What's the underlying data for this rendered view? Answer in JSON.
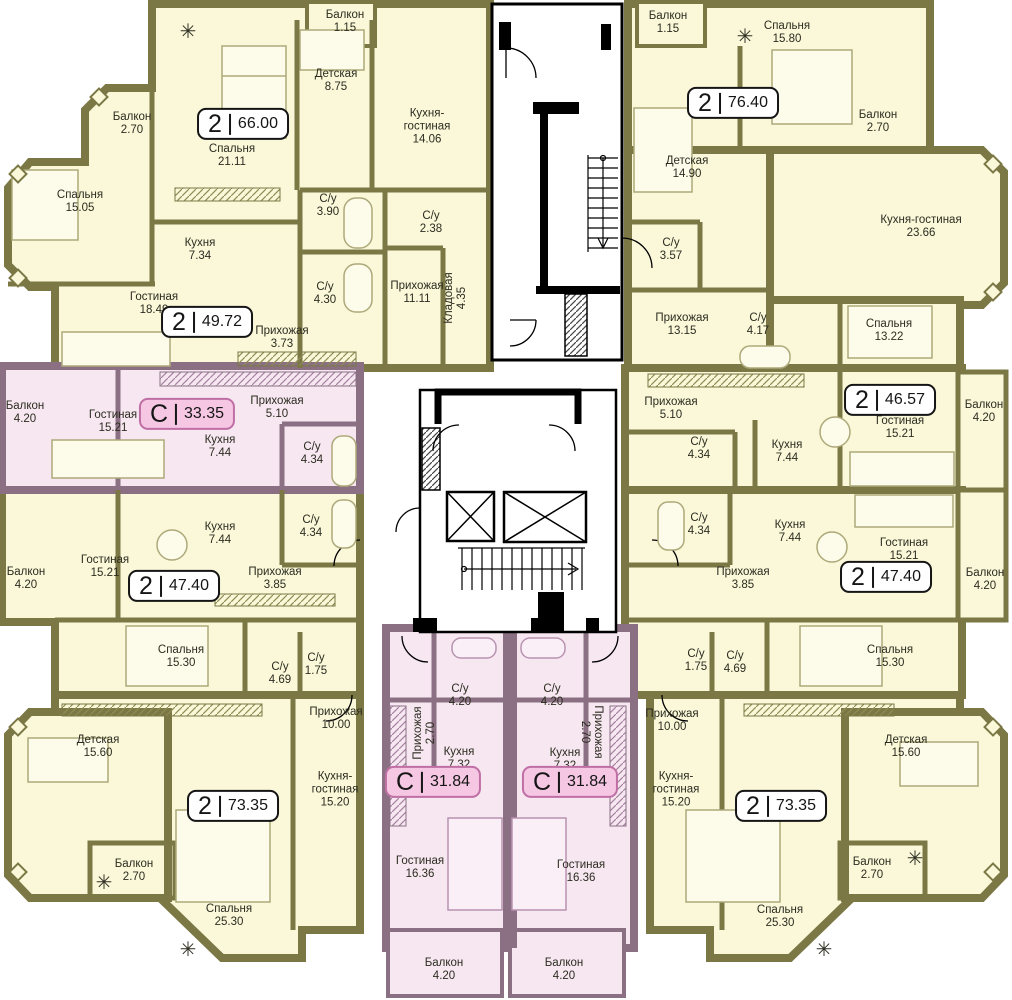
{
  "colors": {
    "apartment_fill": "#FAF8D9",
    "apartment_wall": "#7B7845",
    "studio_fill": "#F6E7F1",
    "studio_wall": "#8A7082",
    "core_wall": "#000000",
    "badge_two_fill": "#FFFFFF",
    "badge_studio_fill": "#F5C7E2",
    "badge_studio_border": "#C06FA5"
  },
  "apartments": [
    {
      "id": "apt-2-66",
      "type": "2",
      "area_total": "66.00",
      "rooms": [
        {
          "name": "Балкон",
          "area": "1.15"
        },
        {
          "name": "Детская",
          "area": "8.75"
        },
        {
          "name": "Кухня-гостиная",
          "area": "14.06"
        },
        {
          "name": "Спальня",
          "area": "21.11"
        },
        {
          "name": "С/у",
          "area": "3.90"
        },
        {
          "name": "С/у",
          "area": "2.38"
        },
        {
          "name": "Прихожая",
          "area": "11.11"
        },
        {
          "name": "Кладовая",
          "area": "4.35"
        }
      ]
    },
    {
      "id": "apt-2-49",
      "type": "2",
      "area_total": "49.72",
      "rooms": [
        {
          "name": "Балкон",
          "area": "2.70"
        },
        {
          "name": "Спальня",
          "area": "15.05"
        },
        {
          "name": "Кухня",
          "area": "7.34"
        },
        {
          "name": "Гостиная",
          "area": "18.49"
        },
        {
          "name": "С/у",
          "area": "4.30"
        },
        {
          "name": "Прихожая",
          "area": "3.73"
        }
      ]
    },
    {
      "id": "studio-33",
      "type": "C",
      "area_total": "33.35",
      "rooms": [
        {
          "name": "Балкон",
          "area": "4.20"
        },
        {
          "name": "Гостиная",
          "area": "15.21"
        },
        {
          "name": "Прихожая",
          "area": "5.10"
        },
        {
          "name": "Кухня",
          "area": "7.44"
        },
        {
          "name": "С/у",
          "area": "4.34"
        }
      ]
    },
    {
      "id": "apt-2-47-left",
      "type": "2",
      "area_total": "47.40",
      "rooms": [
        {
          "name": "Балкон",
          "area": "4.20"
        },
        {
          "name": "Гостиная",
          "area": "15.21"
        },
        {
          "name": "Кухня",
          "area": "7.44"
        },
        {
          "name": "С/у",
          "area": "4.34"
        },
        {
          "name": "Прихожая",
          "area": "3.85"
        },
        {
          "name": "Спальня",
          "area": "15.30"
        },
        {
          "name": "С/у",
          "area": "1.75"
        }
      ]
    },
    {
      "id": "apt-2-73-left",
      "type": "2",
      "area_total": "73.35",
      "rooms": [
        {
          "name": "С/у",
          "area": "4.69"
        },
        {
          "name": "Прихожая",
          "area": "10.00"
        },
        {
          "name": "Детская",
          "area": "15.60"
        },
        {
          "name": "Кухня-гостиная",
          "area": "15.20"
        },
        {
          "name": "Балкон",
          "area": "2.70"
        },
        {
          "name": "Спальня",
          "area": "25.30"
        }
      ]
    },
    {
      "id": "studio-31-left",
      "type": "C",
      "area_total": "31.84",
      "rooms": [
        {
          "name": "С/у",
          "area": "4.20"
        },
        {
          "name": "Прихожая",
          "area": "2.70"
        },
        {
          "name": "Кухня",
          "area": "7.32"
        },
        {
          "name": "Гостиная",
          "area": "16.36"
        },
        {
          "name": "Балкон",
          "area": "4.20"
        }
      ]
    },
    {
      "id": "studio-31-right",
      "type": "C",
      "area_total": "31.84",
      "rooms": [
        {
          "name": "С/у",
          "area": "4.20"
        },
        {
          "name": "Прихожая",
          "area": "2.70"
        },
        {
          "name": "Кухня",
          "area": "7.32"
        },
        {
          "name": "Гостиная",
          "area": "16.36"
        },
        {
          "name": "Балкон",
          "area": "4.20"
        }
      ]
    },
    {
      "id": "apt-2-76",
      "type": "2",
      "area_total": "76.40",
      "rooms": [
        {
          "name": "Балкон",
          "area": "1.15"
        },
        {
          "name": "Спальня",
          "area": "15.80"
        },
        {
          "name": "Балкон",
          "area": "2.70"
        },
        {
          "name": "Детская",
          "area": "14.90"
        },
        {
          "name": "С/у",
          "area": "3.57"
        },
        {
          "name": "Кухня-гостиная",
          "area": "23.66"
        },
        {
          "name": "Прихожая",
          "area": "13.15"
        },
        {
          "name": "С/у",
          "area": "4.17"
        }
      ]
    },
    {
      "id": "apt-2-46",
      "type": "2",
      "area_total": "46.57",
      "rooms": [
        {
          "name": "Спальня",
          "area": "13.22"
        },
        {
          "name": "Прихожая",
          "area": "5.10"
        },
        {
          "name": "С/у",
          "area": "4.34"
        },
        {
          "name": "Кухня",
          "area": "7.44"
        },
        {
          "name": "Гостиная",
          "area": "15.21"
        },
        {
          "name": "Балкон",
          "area": "4.20"
        }
      ]
    },
    {
      "id": "apt-2-47-right",
      "type": "2",
      "area_total": "47.40",
      "rooms": [
        {
          "name": "С/у",
          "area": "4.34"
        },
        {
          "name": "Кухня",
          "area": "7.44"
        },
        {
          "name": "Гостиная",
          "area": "15.21"
        },
        {
          "name": "Прихожая",
          "area": "3.85"
        },
        {
          "name": "Балкон",
          "area": "4.20"
        },
        {
          "name": "Спальня",
          "area": "15.30"
        },
        {
          "name": "С/у",
          "area": "1.75"
        }
      ]
    },
    {
      "id": "apt-2-73-right",
      "type": "2",
      "area_total": "73.35",
      "rooms": [
        {
          "name": "С/у",
          "area": "4.69"
        },
        {
          "name": "Прихожая",
          "area": "10.00"
        },
        {
          "name": "Детская",
          "area": "15.60"
        },
        {
          "name": "Кухня-гостиная",
          "area": "15.20"
        },
        {
          "name": "Балкон",
          "area": "2.70"
        },
        {
          "name": "Спальня",
          "area": "25.30"
        }
      ]
    }
  ]
}
